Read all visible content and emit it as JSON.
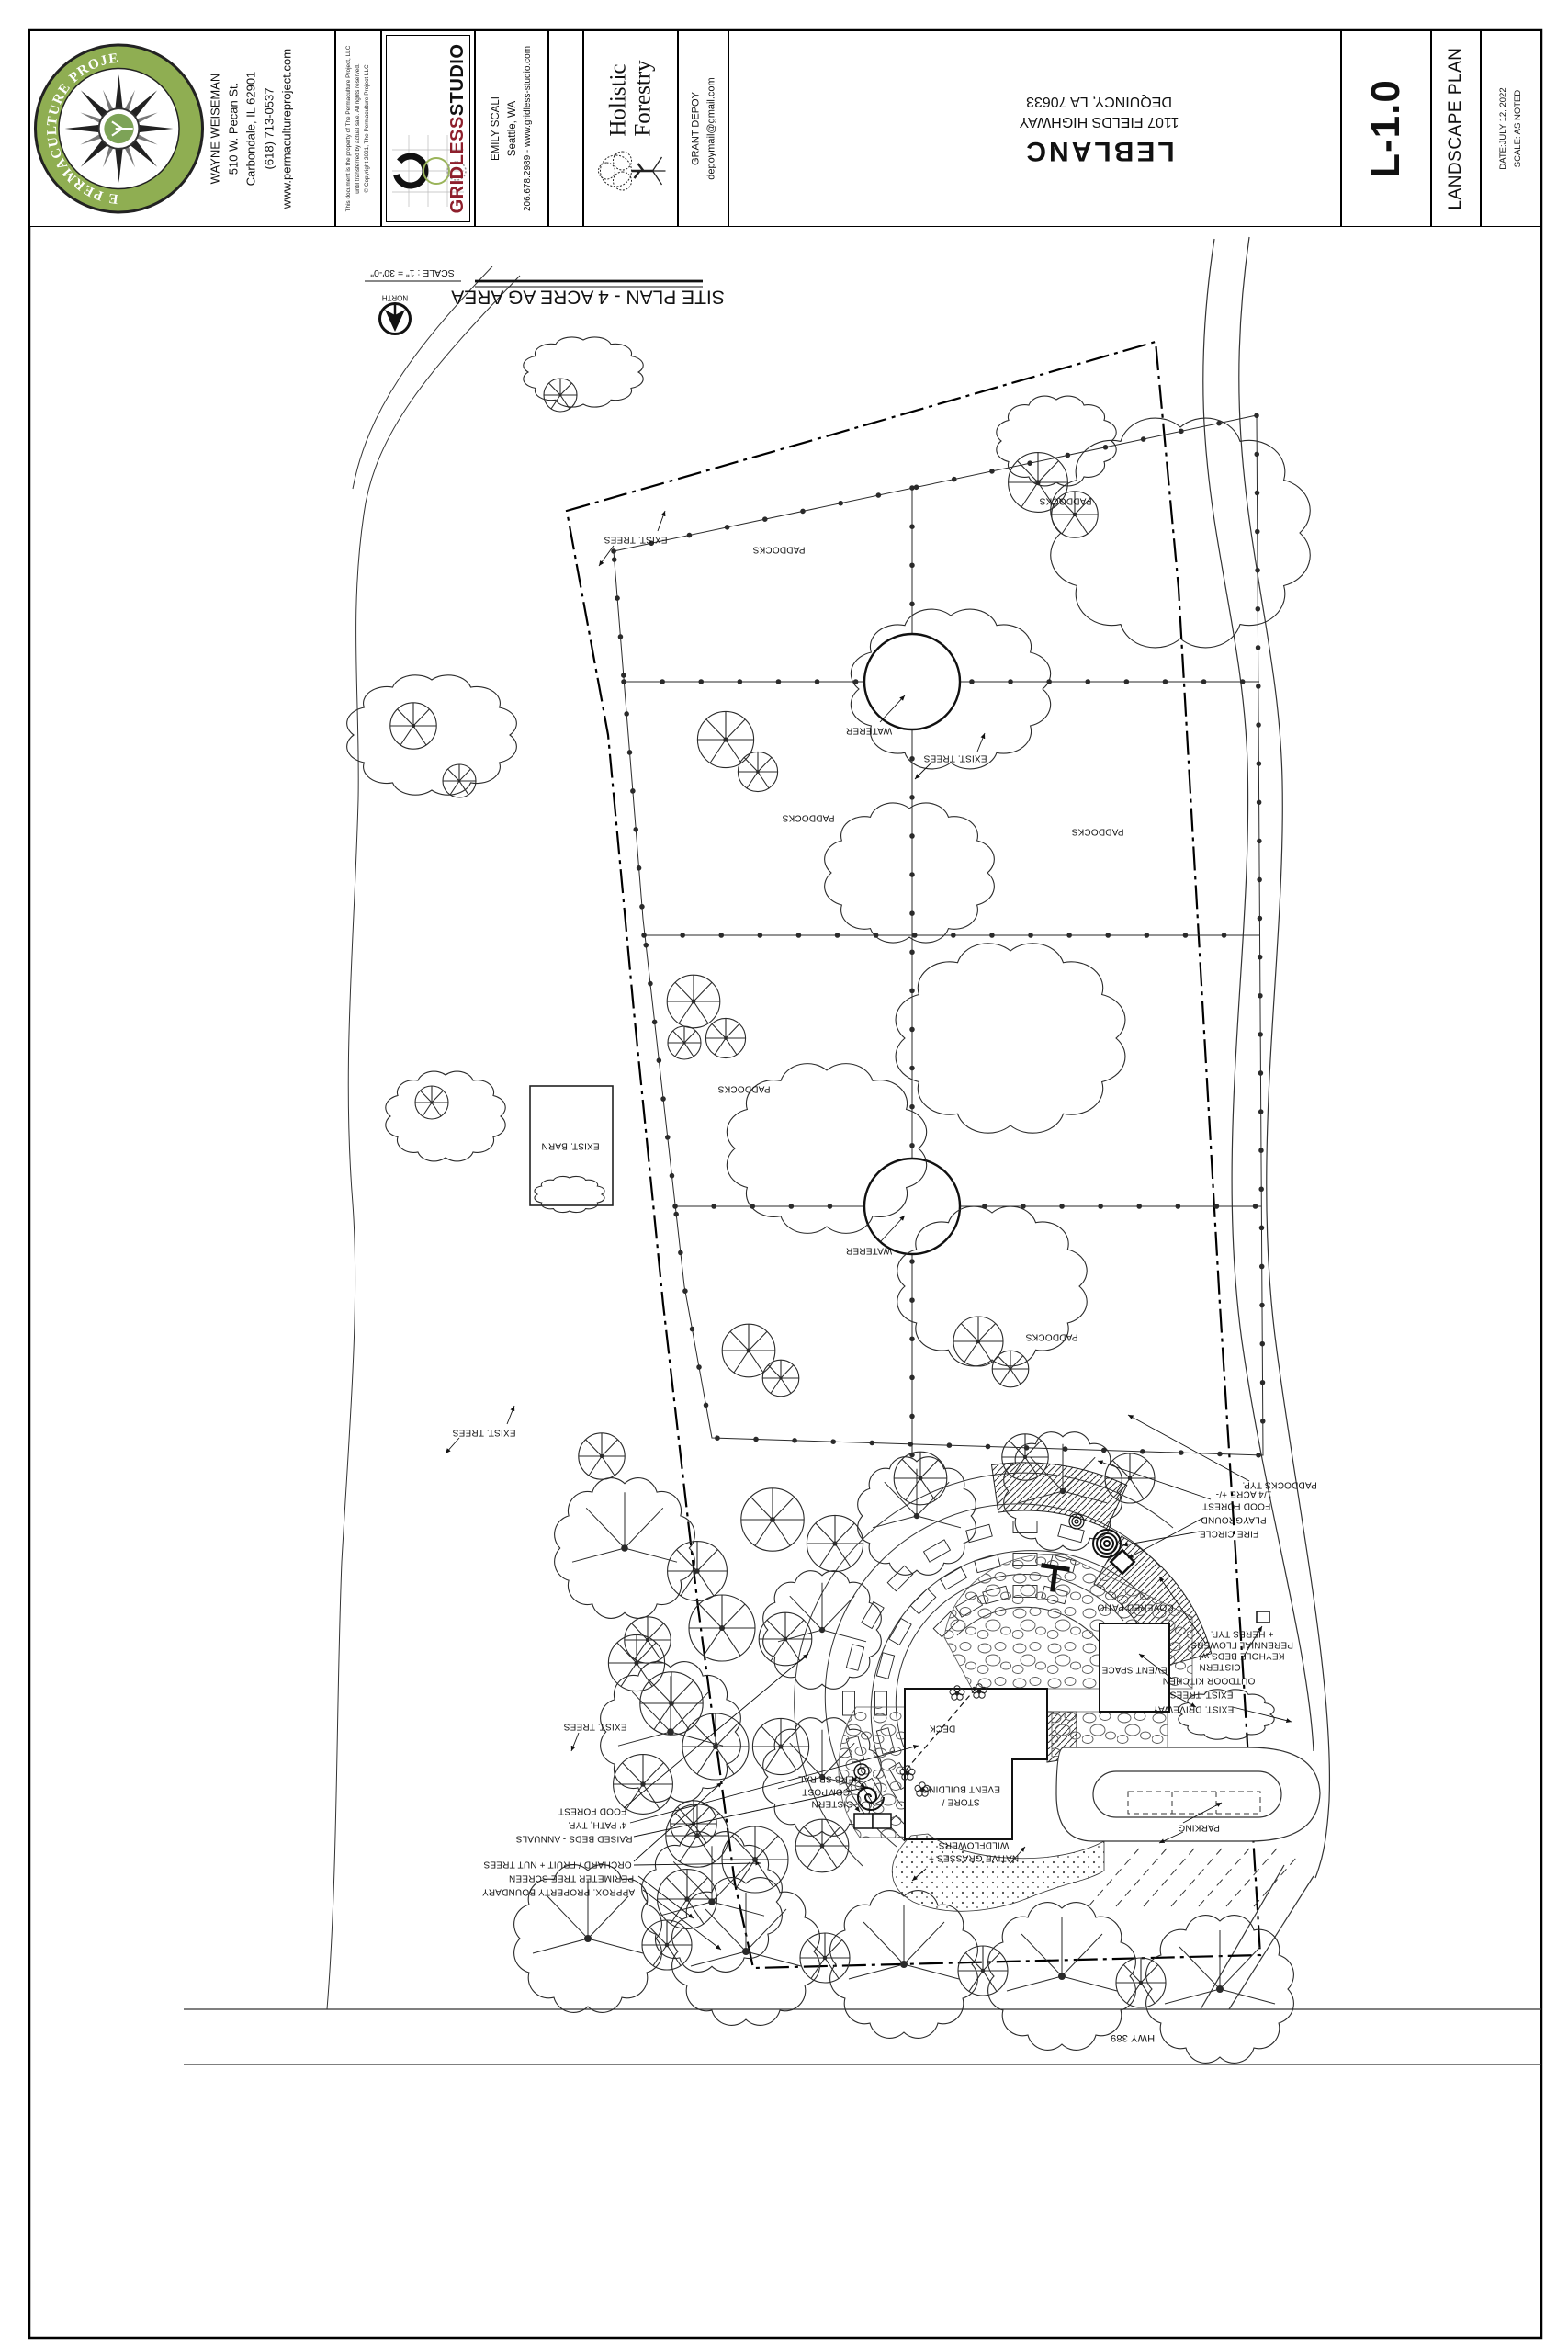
{
  "title_block": {
    "permaculture": {
      "logo_arc_top": "THE PERMACULTURE PROJECT",
      "logo_llc": "LLC",
      "logo_arc_bottom": "Permaculture Design and Education",
      "name": "WAYNE WEISEMAN",
      "address1": "510 W. Pecan St.",
      "address2": "Carbondale, IL 62901",
      "phone": "(618) 713-0537",
      "website": "www.permacultureproject.com"
    },
    "legal": {
      "line1": "This document is the property of The Permaculture Project, LLC",
      "line2": "until transferred by actual sale.  All rights reserved.",
      "line3": "© Copyright 2021, The Permaculture Project LLC"
    },
    "gridless": {
      "name_red": "GRIDLESS",
      "name_black": "STUDIO",
      "contact_name": "EMILY SCALI",
      "contact_city": "Seattle, WA",
      "contact_line": "206.678.2989  -  www.gridless-studio.com"
    },
    "holistic": {
      "logo_line1": "Holistic",
      "logo_line2": "Forestry",
      "contact_name": "GRANT DEPOY",
      "contact_email": "depoymail@gmail.com"
    },
    "project": {
      "client": "LEBLANC",
      "address1": "1107 FIELDS HIGHWAY",
      "address2": "DEQUINCY, LA 70633"
    },
    "sheet": {
      "number": "L-1.0",
      "title": "LANDSCAPE PLAN",
      "date": "DATE:JULY 12, 2022",
      "scale": "SCALE:  AS NOTED"
    }
  },
  "drawing": {
    "view_title": "SITE PLAN - 4 ACRE AG AREA",
    "view_scale": "SCALE : 1\" = 30'-0\"",
    "north_label": "NORTH",
    "labels": {
      "exist_trees": "EXIST. TREES",
      "paddocks": "PADDOCKS",
      "paddocks_typ": "PADDOCKS TYP.",
      "waterer": "WATERER",
      "exist_barn": "EXIST. BARN",
      "quarter_acre": "1/4 ACRE +/-",
      "food_forest": "FOOD FOREST",
      "playground": "PLAYGROUND",
      "fire_circle": "FIRE CIRCLE",
      "covered_patio": "COVERED PATIO",
      "keyhole1": "KEYHOLE BEDS w/",
      "keyhole2": "PERENNIAL FLOWERS",
      "keyhole3": "+ HERBS TYP.",
      "cistern": "CISTERN",
      "outdoor_kitchen": "OUTDOOR KITCHEN",
      "exist_driveway": "EXIST. DRIVEWAY",
      "event_space": "EVENT SPACE",
      "deck": "DECK",
      "store_building1": "STORE /",
      "store_building2": "EVENT BUILDING",
      "native_grasses1": "NATIVE GRASSES +",
      "native_grasses2": "WILDFLOWERS",
      "parking": "PARKING",
      "herb_spiral": "HERB SPIRAL",
      "compost": "COMPOST",
      "path_typ": "4' PATH, TYP.",
      "raised_beds": "RAISED BEDS - ANNUALS",
      "orchard": "ORCHARD / FRUIT + NUT TREES",
      "perimeter": "PERIMETER TREE SCREEN",
      "property_boundary": "APPROX. PROPERTY BOUNDARY",
      "hwy": "HWY 389"
    }
  },
  "colors": {
    "logo_green": "#8fae52",
    "gridless_red": "#8e1f2c",
    "line": "#1a1a1a"
  }
}
